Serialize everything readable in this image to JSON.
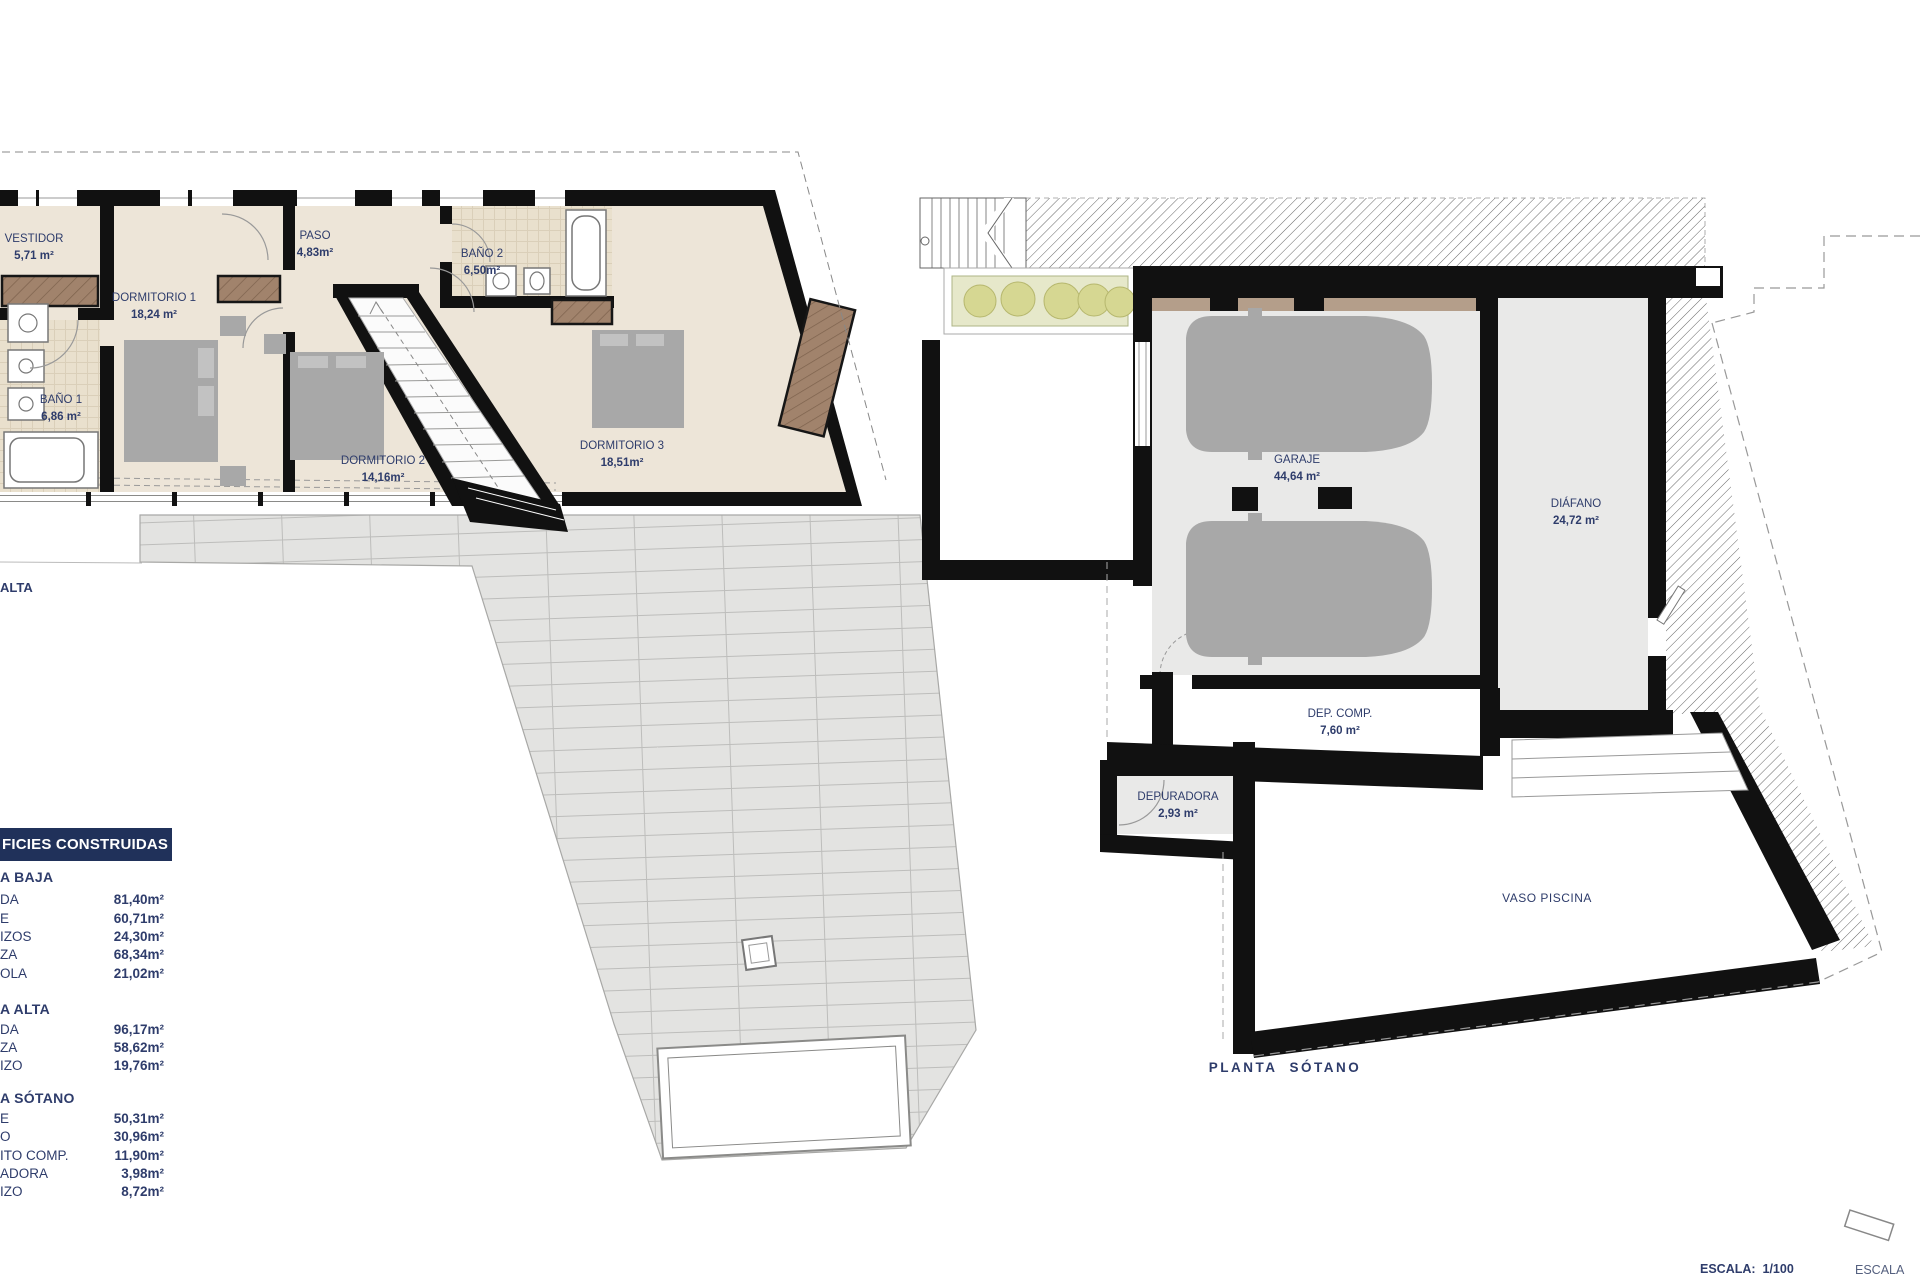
{
  "colors": {
    "label_navy": "#2e3c6b",
    "legend_bar_bg": "#20315a",
    "wall_black": "#111111",
    "floor_beige": "#ede5d8",
    "floor_gray": "#e9e9e8",
    "furniture_gray": "#a8a8a8",
    "wood_brown": "#a1836c",
    "planter_green": "#d6d792"
  },
  "left_plan": {
    "floor_label": "ALTA",
    "rooms": [
      {
        "name": "VESTIDOR",
        "area": "5,71 m²"
      },
      {
        "name": "DORMITORIO 1",
        "area": "18,24 m²"
      },
      {
        "name": "PASO",
        "area": "4,83m²"
      },
      {
        "name": "BAÑO 2",
        "area": "6,50m²"
      },
      {
        "name": "BAÑO 1",
        "area": "6,86 m²"
      },
      {
        "name": "DORMITORIO 2",
        "area": "14,16m²"
      },
      {
        "name": "DORMITORIO 3",
        "area": "18,51m²"
      }
    ]
  },
  "right_plan": {
    "floor_label": "PLANTA  SÓTANO",
    "rooms": [
      {
        "name": "GARAJE",
        "area": "44,64 m²"
      },
      {
        "name": "DIÁFANO",
        "area": "24,72 m²"
      },
      {
        "name": "DEP. COMP.",
        "area": "7,60 m²"
      },
      {
        "name": "DEPURADORA",
        "area": "2,93 m²"
      },
      {
        "name": "VASO PISCINA"
      }
    ]
  },
  "legend": {
    "title": "FICIES CONSTRUIDAS",
    "sections": [
      {
        "heading": "A BAJA",
        "rows": [
          {
            "label": "DA",
            "value": "81,40m²"
          },
          {
            "label": "E",
            "value": "60,71m²"
          },
          {
            "label": "IZOS",
            "value": "24,30m²"
          },
          {
            "label": "ZA",
            "value": "68,34m²"
          },
          {
            "label": "OLA",
            "value": "21,02m²"
          }
        ]
      },
      {
        "heading": "A ALTA",
        "rows": [
          {
            "label": "DA",
            "value": "96,17m²"
          },
          {
            "label": "ZA",
            "value": "58,62m²"
          },
          {
            "label": "IZO",
            "value": "19,76m²"
          }
        ]
      },
      {
        "heading": "A SÓTANO",
        "rows": [
          {
            "label": "E",
            "value": "50,31m²"
          },
          {
            "label": "O",
            "value": "30,96m²"
          },
          {
            "label": "ITO COMP.",
            "value": "11,90m²"
          },
          {
            "label": "ADORA",
            "value": "3,98m²"
          },
          {
            "label": "IZO",
            "value": "8,72m²"
          }
        ]
      }
    ]
  },
  "footer": {
    "scale_main": "ESCALA:  1/100",
    "scale_side": "ESCALA"
  }
}
